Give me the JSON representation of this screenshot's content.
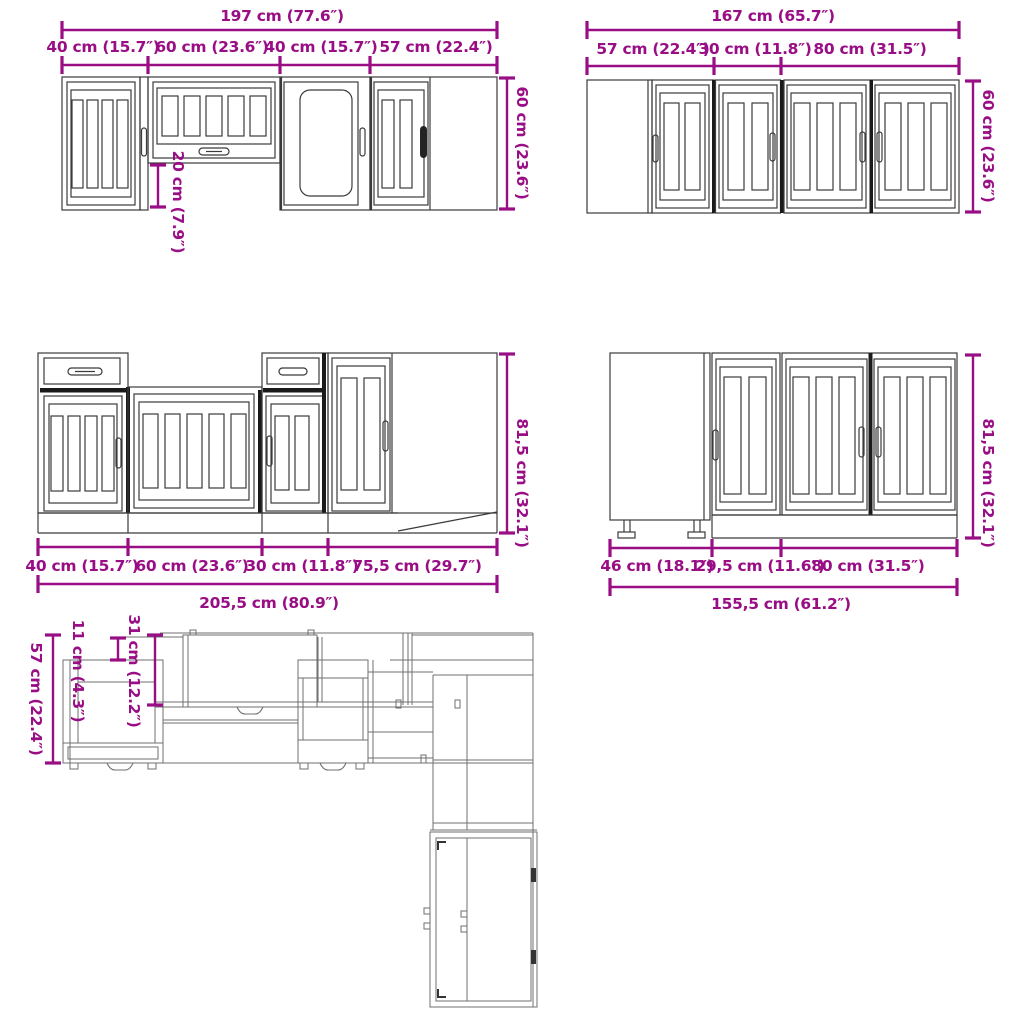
{
  "diagram": {
    "colors": {
      "dimension_accent": "#990d85",
      "drawing_line": "#3b3b3b",
      "plan_line": "#6f6f6f"
    },
    "groups": {
      "wall_left": {
        "total": "197 cm (77.6″)",
        "segments": [
          "40 cm (15.7″)",
          "60 cm (23.6″)",
          "40 cm (15.7″)",
          "57 cm (22.4″)"
        ],
        "height": "60 cm (23.6″)",
        "gap_height": "20 cm (7.9″)"
      },
      "wall_right": {
        "total": "167 cm (65.7″)",
        "segments": [
          "57 cm (22.4″)",
          "30 cm (11.8″)",
          "80 cm (31.5″)"
        ],
        "height": "60 cm (23.6″)"
      },
      "base_left": {
        "total": "205,5 cm (80.9″)",
        "segments": [
          "40 cm (15.7″)",
          "60 cm (23.6″)",
          "30 cm (11.8″)",
          "75,5 cm (29.7″)"
        ],
        "height": "81,5 cm (32.1″)"
      },
      "base_right": {
        "total": "155,5 cm (61.2″)",
        "segments": [
          "46 cm (18.1″)",
          "29,5 cm (11.6″)",
          "80 cm (31.5″)"
        ],
        "height": "81,5 cm (32.1″)"
      },
      "plan": {
        "depth_total": "57 cm (22.4″)",
        "depth_upper": "11 cm (4.3″)",
        "depth_wall": "31 cm (12.2″)"
      }
    }
  }
}
